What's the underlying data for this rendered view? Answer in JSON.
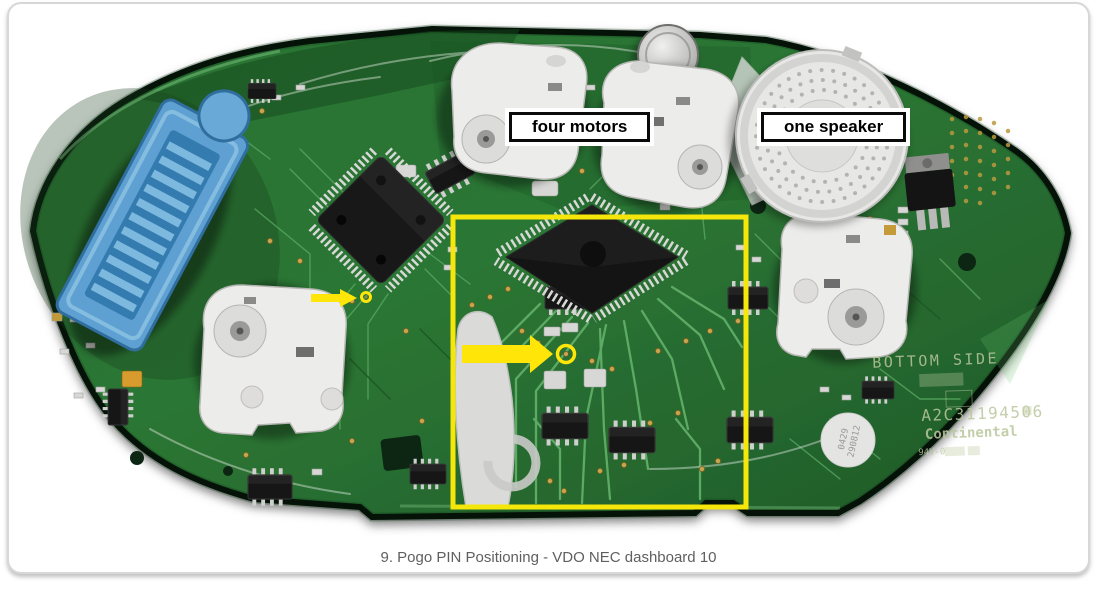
{
  "figure": {
    "caption": "9. Pogo PIN Positioning - VDO NEC dashboard 10"
  },
  "annotations": {
    "four_motors": "four motors",
    "one_speaker": "one speaker"
  },
  "pcb": {
    "silkscreen": {
      "bottom_side": "BOTTOM SIDE",
      "part_number": "A2C31194506",
      "brand": "Continental",
      "flammability": "94V-0"
    },
    "sticker": {
      "line1": "0429",
      "line2": "290812"
    }
  },
  "colors": {
    "pcb_green": "#2c7634",
    "annotation_yellow": "#ffe608",
    "connector_blue": "#5fa0d2",
    "label_border": "#0a0a0a",
    "caption_text": "#5f5f5f"
  }
}
